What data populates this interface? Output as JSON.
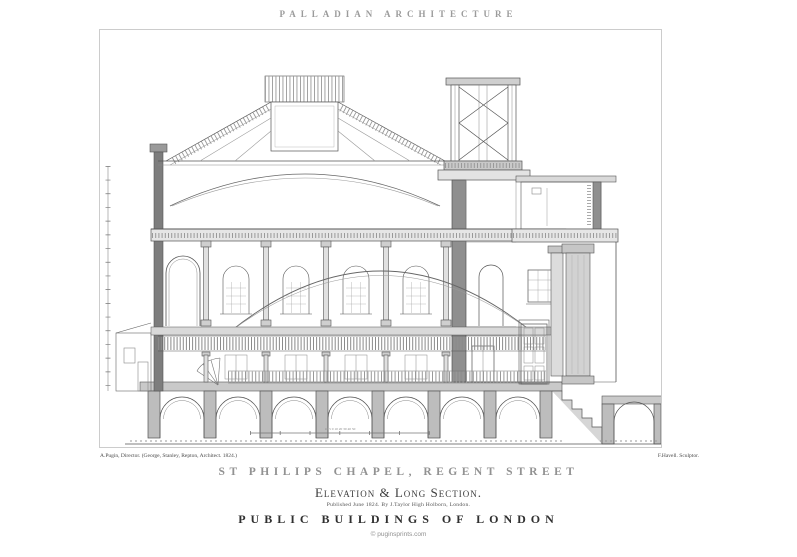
{
  "page": {
    "background": "#ffffff",
    "ink": "#555555",
    "frame_color": "#cccccc"
  },
  "header": {
    "title": "PALLADIAN ARCHITECTURE"
  },
  "plate": {
    "scale_numbers": "10 5 0 10 20 30 40 50"
  },
  "credits": {
    "left": "A.Pugin, Director. (George, Stanley, Repton, Architect. 1824.)",
    "right": "F.Havell. Sculptor."
  },
  "titles": {
    "main": "ST PHILIPS CHAPEL, REGENT STREET",
    "subtitle": "Elevation & Long Section.",
    "imprint": "Published June 1824. By J.Taylor High Holborn, London.",
    "series": "PUBLIC BUILDINGS OF LONDON"
  },
  "footer": {
    "copyright": "© puginsprints.com"
  }
}
